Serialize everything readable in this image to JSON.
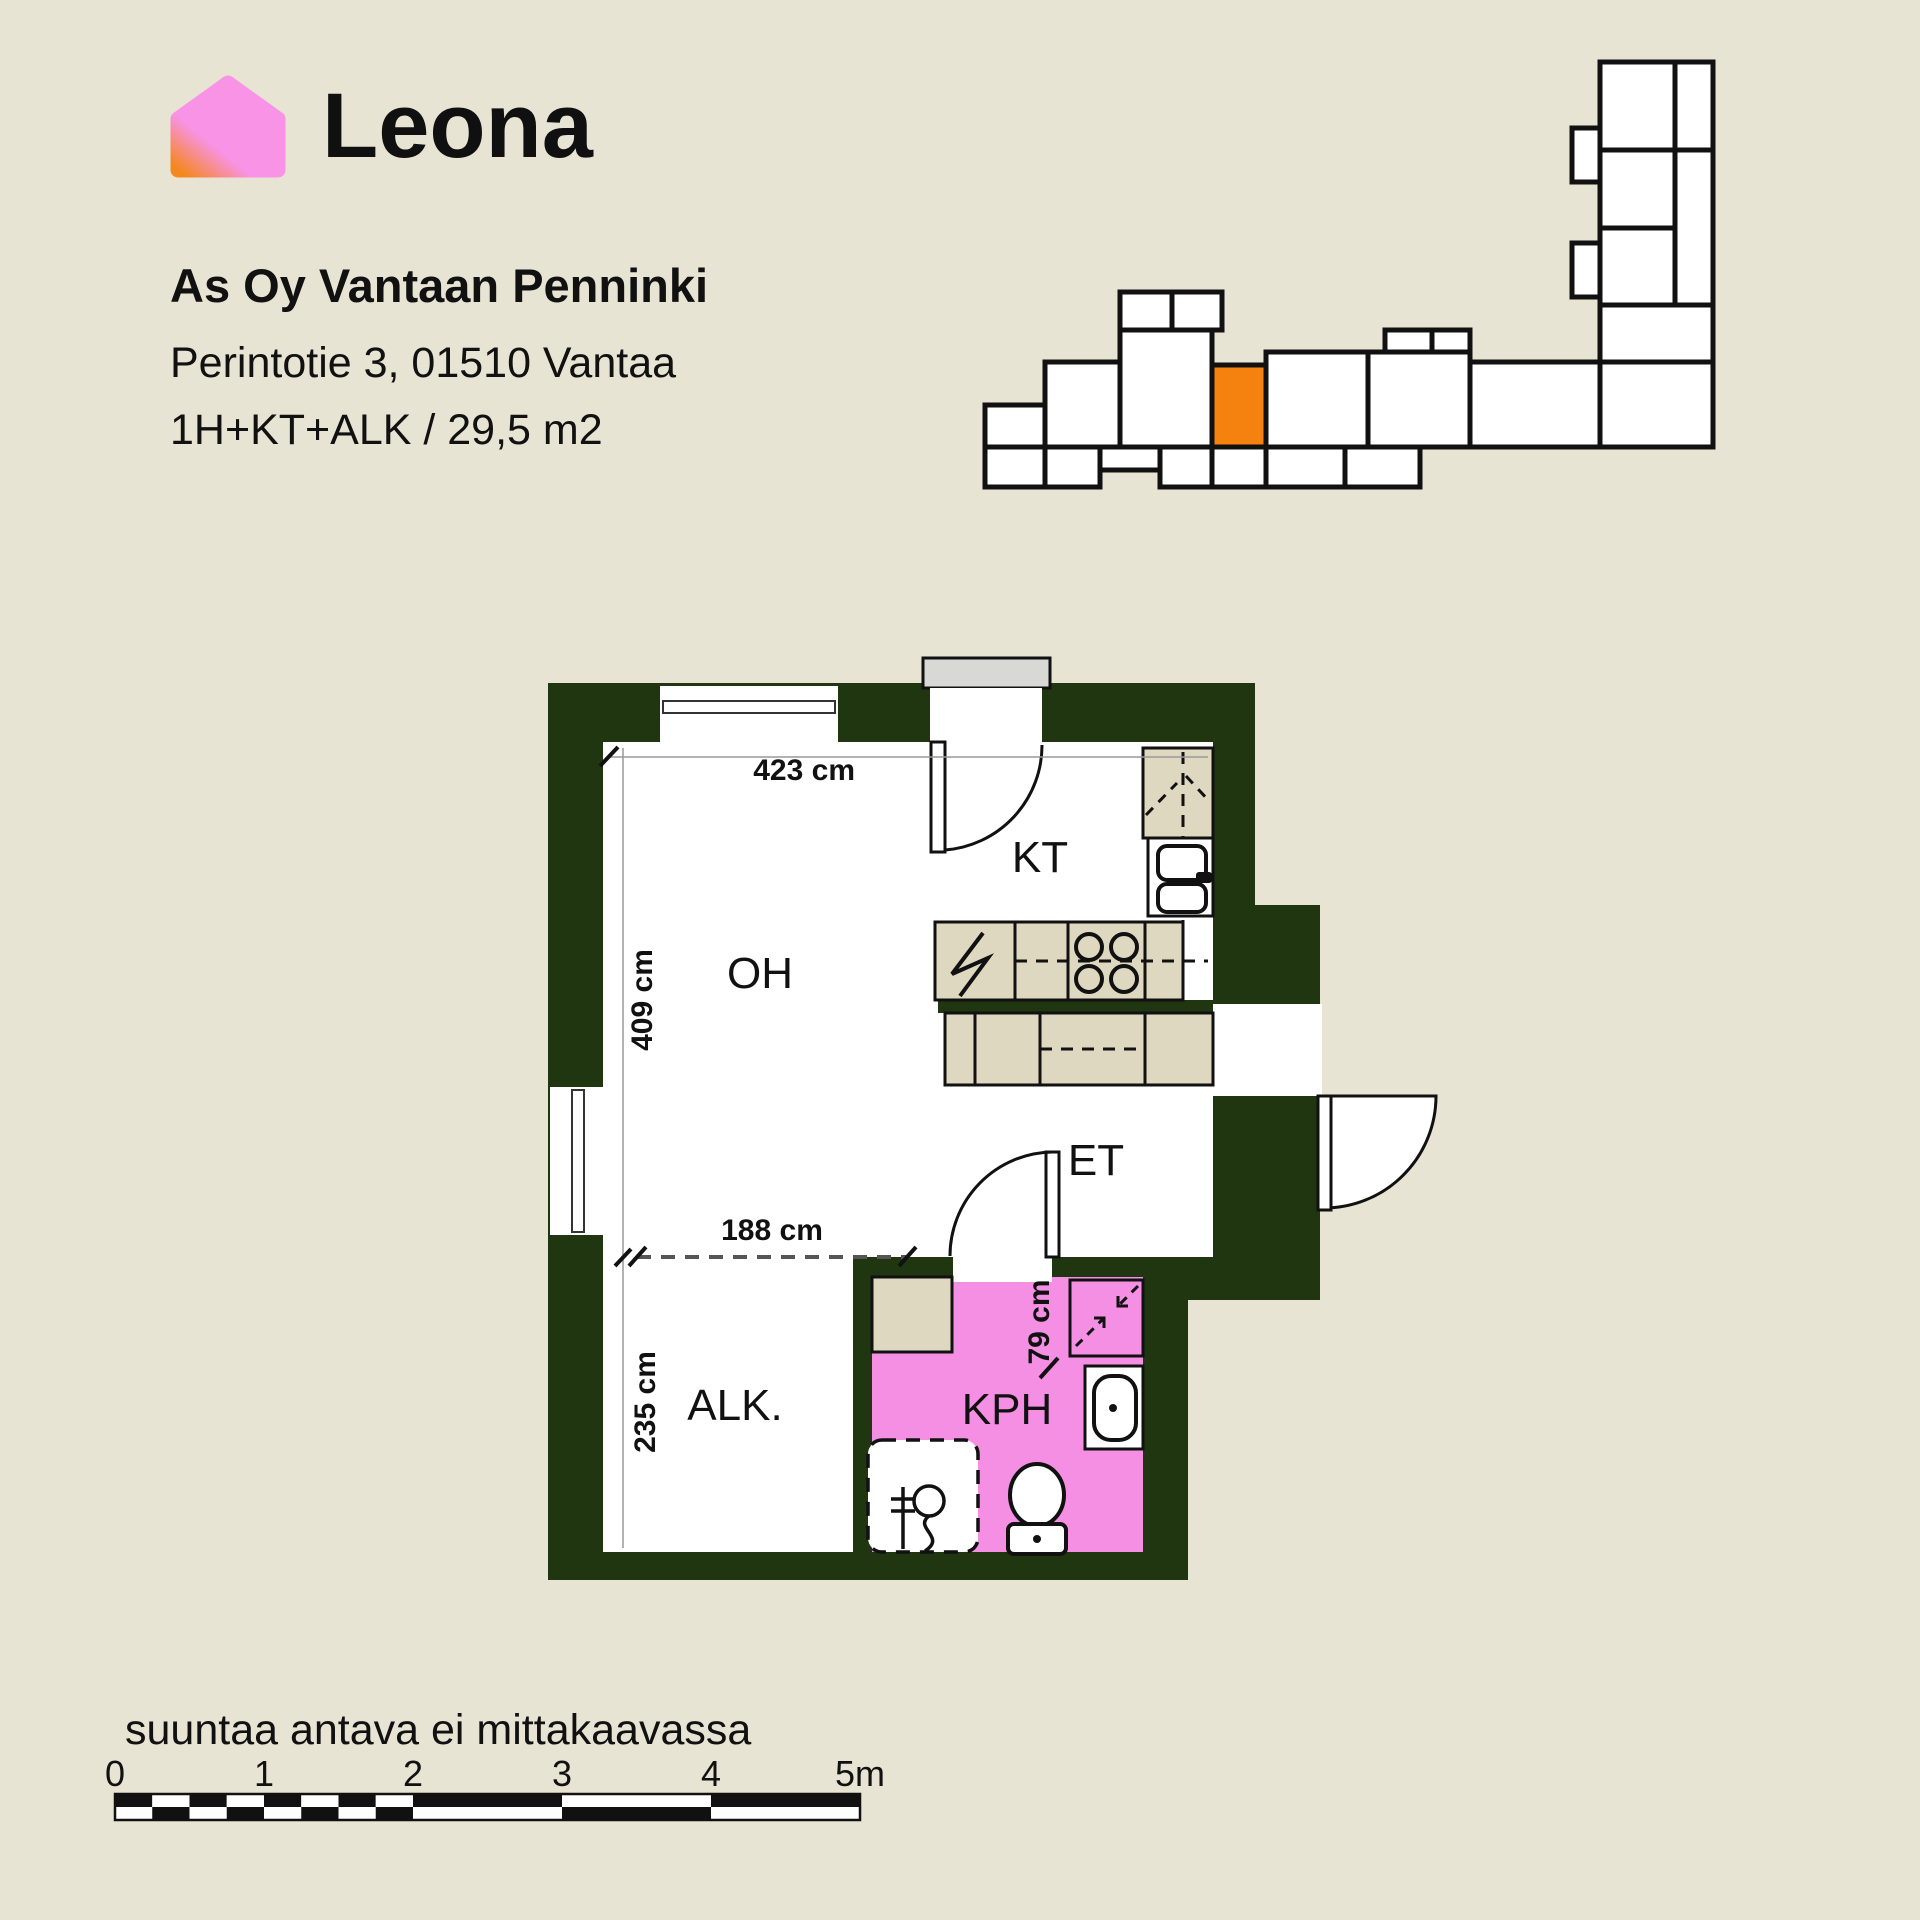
{
  "logo": {
    "text": "Leona",
    "icon": "leona-house-icon",
    "pink": "#f893e6",
    "orange": "#f5871c"
  },
  "listing": {
    "name": "As Oy Vantaan Penninki",
    "address": "Perintotie 3, 01510 Vantaa",
    "type": "1H+KT+ALK / 29,5 m2"
  },
  "site_plan": {
    "description": "building-outline-with-highlighted-unit",
    "highlight_color": "#f5820e",
    "unit_fill": "#ffffff",
    "outline_color": "#111111"
  },
  "floor_plan": {
    "wall_color": "#203611",
    "bathroom_color": "#f58fe4",
    "fixture_color": "#ded8c0",
    "threshold_color": "#d8d8d4",
    "rooms": [
      {
        "label": "OH"
      },
      {
        "label": "KT"
      },
      {
        "label": "ET"
      },
      {
        "label": "ALK."
      },
      {
        "label": "KPH"
      }
    ],
    "dimensions": [
      {
        "label": "423 cm"
      },
      {
        "label": "409 cm"
      },
      {
        "label": "188 cm"
      },
      {
        "label": "235 cm"
      },
      {
        "label": "79 cm"
      }
    ]
  },
  "footer": {
    "disclaimer": "suuntaa antava ei mittakaavassa",
    "scale_labels": [
      "0",
      "1",
      "2",
      "3",
      "4",
      "5m"
    ]
  }
}
